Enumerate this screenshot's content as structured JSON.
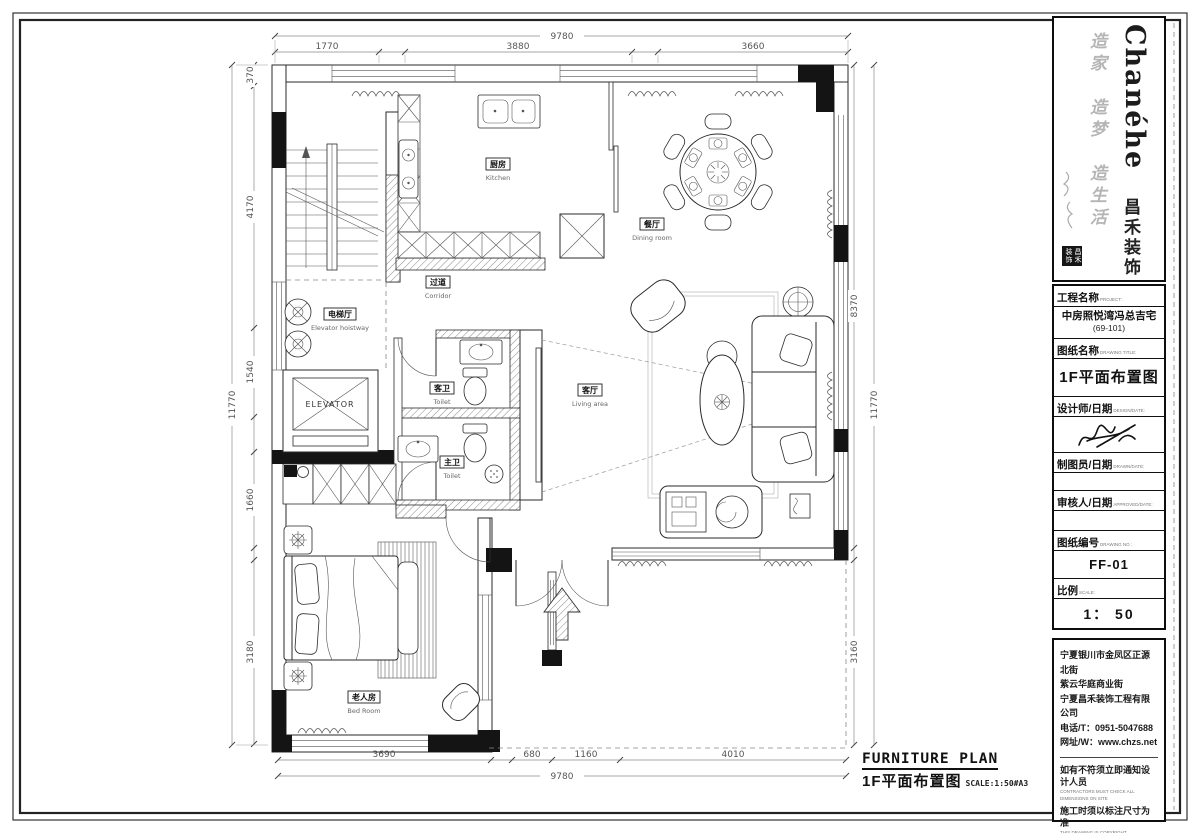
{
  "logo": {
    "brand_en": "Chanéhe",
    "brand_zh": "昌禾装饰",
    "slogan": "造家　造梦　造生活",
    "seal_text": "昌禾装饰"
  },
  "title_block": {
    "project": {
      "label_zh": "工程名称",
      "label_en": "PROJECT:",
      "value_line1": "中房照悦湾冯总吉宅",
      "value_line2": "(69-101)"
    },
    "drawing_title": {
      "label_zh": "图纸名称",
      "label_en": "DRAWING TITLE:",
      "value": "1F平面布置图"
    },
    "designer": {
      "label_zh": "设计师/日期",
      "label_en": "DESIGN/DATE:"
    },
    "drafter": {
      "label_zh": "制图员/日期",
      "label_en": "DRAWN/DATE:"
    },
    "approver": {
      "label_zh": "审核人/日期",
      "label_en": "APPROVED/DATE:"
    },
    "drawing_no": {
      "label_zh": "图纸编号",
      "label_en": "DRAWING NO :",
      "value": "FF-01"
    },
    "scale": {
      "label_zh": "比例",
      "label_en": "SCALE:",
      "value": "1： 50"
    }
  },
  "company": {
    "address_line1": "宁夏银川市金凤区正源北街",
    "address_line2": "紫云华庭商业街",
    "company_name": "宁夏昌禾装饰工程有限公司",
    "phone": "电话/T：0951-5047688",
    "website": "网址/W：www.chzs.net"
  },
  "notes": {
    "note1_zh": "如有不符须立即通知设计人员",
    "note1_en": "CONTRACTORS MUST CHECK ALL DIMENSIONS ON SITE",
    "note2_zh": "施工时须以标注尺寸为准",
    "note2_en": "THIS DRAWING IS COPYRIGHT"
  },
  "footer": {
    "title_en": "FURNITURE PLAN",
    "title_zh": "1F平面布置图",
    "scale_note": "SCALE:1:50#A3"
  },
  "plan": {
    "elevator_label": "ELEVATOR",
    "rooms": {
      "kitchen": {
        "zh": "厨房",
        "en": "Kitchen"
      },
      "dining": {
        "zh": "餐厅",
        "en": "Dining room"
      },
      "corridor": {
        "zh": "过道",
        "en": "Corridor"
      },
      "elevator_hall": {
        "zh": "电梯厅",
        "en": "Elevator hoistway"
      },
      "toilet_guest": {
        "zh": "客卫",
        "en": "Toilet"
      },
      "toilet_master": {
        "zh": "主卫",
        "en": "Toilet"
      },
      "living": {
        "zh": "客厅",
        "en": "Living area"
      },
      "bedroom": {
        "zh": "老人房",
        "en": "Bed Room"
      }
    },
    "dimensions": {
      "top_overall": "9780",
      "top_segments": [
        "1770",
        "3880",
        "3660"
      ],
      "bottom_overall": "9780",
      "bottom_segments": [
        "3690",
        "680",
        "1160",
        "4010"
      ],
      "left_overall": "11770",
      "left_segments": [
        "370",
        "4170",
        "1540",
        "1660",
        "3180"
      ],
      "right_overall": "11770",
      "right_segments": [
        "8370",
        "3160"
      ]
    }
  }
}
